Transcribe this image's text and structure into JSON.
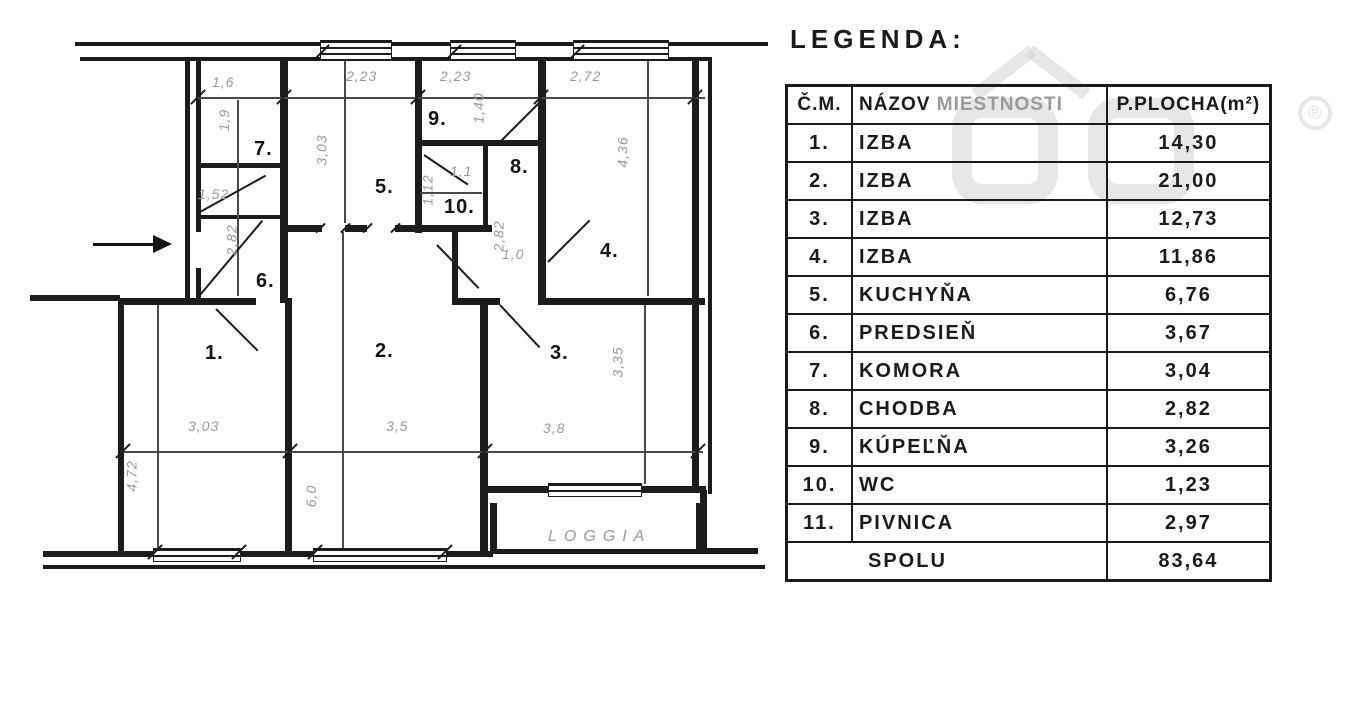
{
  "legend": {
    "title": "LEGENDA:",
    "table": {
      "headers": {
        "col_no": "Č.M.",
        "col_name_primary": "NÁZOV",
        "col_name_secondary": "MIESTNOSTI",
        "col_area": "P.PLOCHA(m²)"
      },
      "rows": [
        {
          "no": "1.",
          "name": "IZBA",
          "area": "14,30"
        },
        {
          "no": "2.",
          "name": "IZBA",
          "area": "21,00"
        },
        {
          "no": "3.",
          "name": "IZBA",
          "area": "12,73"
        },
        {
          "no": "4.",
          "name": "IZBA",
          "area": "11,86"
        },
        {
          "no": "5.",
          "name": "KUCHYŇA",
          "area": "6,76"
        },
        {
          "no": "6.",
          "name": "PREDSIEŇ",
          "area": "3,67"
        },
        {
          "no": "7.",
          "name": "KOMORA",
          "area": "3,04"
        },
        {
          "no": "8.",
          "name": "CHODBA",
          "area": "2,82"
        },
        {
          "no": "9.",
          "name": "KÚPEĽŇA",
          "area": "3,26"
        },
        {
          "no": "10.",
          "name": "WC",
          "area": "1,23"
        },
        {
          "no": "11.",
          "name": "PIVNICA",
          "area": "2,97"
        }
      ],
      "total": {
        "label": "SPOLU",
        "area": "83,64"
      }
    }
  },
  "plan": {
    "loggia_label": {
      "text": "LOGGIA",
      "x": 548,
      "y": 528
    },
    "room_labels": [
      {
        "text": "1.",
        "x": 205,
        "y": 342
      },
      {
        "text": "2.",
        "x": 375,
        "y": 340
      },
      {
        "text": "3.",
        "x": 550,
        "y": 342
      },
      {
        "text": "4.",
        "x": 600,
        "y": 240
      },
      {
        "text": "5.",
        "x": 375,
        "y": 176
      },
      {
        "text": "6.",
        "x": 256,
        "y": 270
      },
      {
        "text": "7.",
        "x": 254,
        "y": 138
      },
      {
        "text": "8.",
        "x": 510,
        "y": 156
      },
      {
        "text": "9.",
        "x": 428,
        "y": 108
      },
      {
        "text": "10.",
        "x": 444,
        "y": 196
      }
    ],
    "dimension_labels": [
      {
        "text": "1,6",
        "x": 212,
        "y": 74,
        "rot": 0
      },
      {
        "text": "1,9",
        "x": 213,
        "y": 112,
        "rot": 1
      },
      {
        "text": "1,52",
        "x": 198,
        "y": 186,
        "rot": 0
      },
      {
        "text": "2,82",
        "x": 216,
        "y": 232,
        "rot": 1
      },
      {
        "text": "2,23",
        "x": 346,
        "y": 68,
        "rot": 0
      },
      {
        "text": "3,03",
        "x": 306,
        "y": 142,
        "rot": 1
      },
      {
        "text": "2,23",
        "x": 440,
        "y": 68,
        "rot": 0
      },
      {
        "text": "1,40",
        "x": 463,
        "y": 100,
        "rot": 1
      },
      {
        "text": "1,1",
        "x": 450,
        "y": 163,
        "rot": 0
      },
      {
        "text": "1,12",
        "x": 412,
        "y": 182,
        "rot": 1
      },
      {
        "text": "2,82",
        "x": 483,
        "y": 228,
        "rot": 1
      },
      {
        "text": "1,0",
        "x": 502,
        "y": 246,
        "rot": 0
      },
      {
        "text": "2,72",
        "x": 570,
        "y": 68,
        "rot": 0
      },
      {
        "text": "4,36",
        "x": 607,
        "y": 144,
        "rot": 1
      },
      {
        "text": "3,03",
        "x": 188,
        "y": 418,
        "rot": 0
      },
      {
        "text": "4,72",
        "x": 116,
        "y": 468,
        "rot": 1
      },
      {
        "text": "3,5",
        "x": 386,
        "y": 418,
        "rot": 0
      },
      {
        "text": "6,0",
        "x": 300,
        "y": 488,
        "rot": 1
      },
      {
        "text": "3,8",
        "x": 543,
        "y": 420,
        "rot": 0
      },
      {
        "text": "3,35",
        "x": 602,
        "y": 354,
        "rot": 1
      }
    ]
  },
  "watermark": {
    "reg_symbol": "®"
  }
}
